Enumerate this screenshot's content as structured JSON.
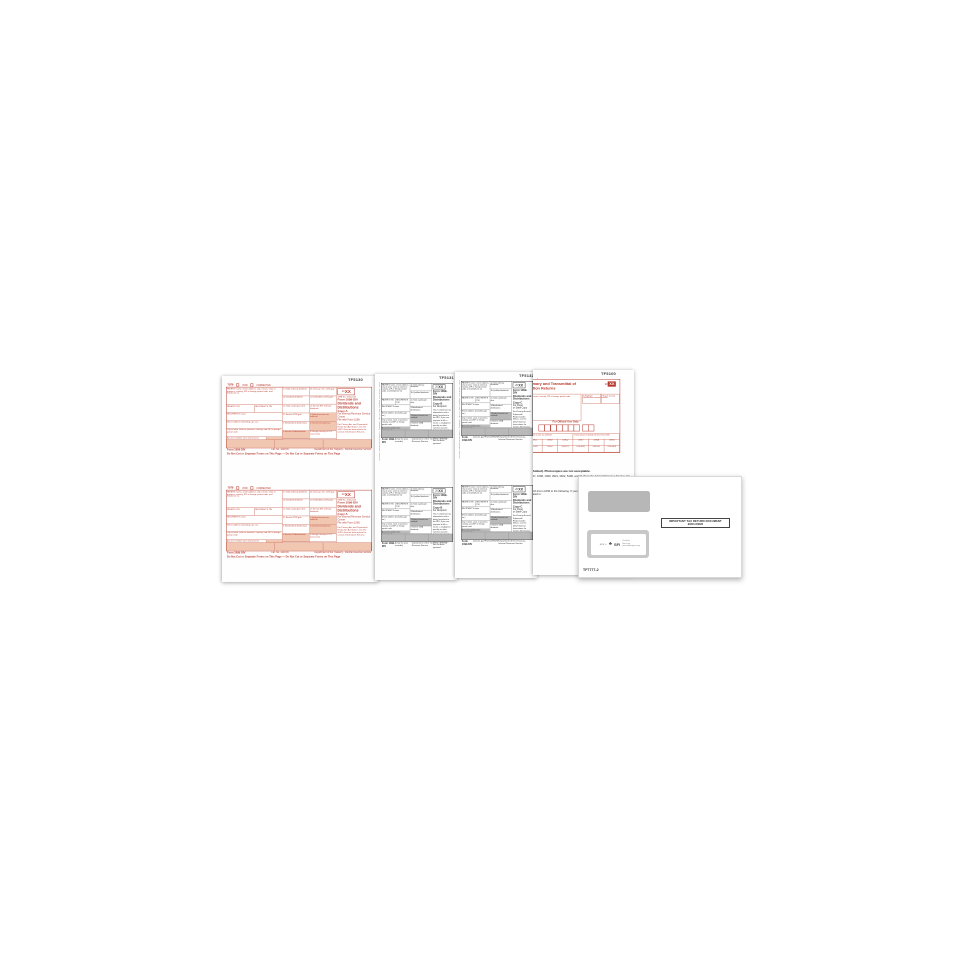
{
  "scene": {
    "description": "1099-DIV laser tax form set with double-window envelope on white background"
  },
  "sheet_codes": {
    "s1": "TF5130",
    "s2": "TF5131",
    "s3": "TF5132",
    "s4": "TF5100"
  },
  "edges": {
    "div_edge": "Form 1099-DIV   Department of the Treasury - Internal Revenue Service",
    "transmittal_edge": "Form 1096   Department of the Treasury Internal Revenue Service"
  },
  "form1099": {
    "corner": "7979",
    "void_label": "VOID",
    "corrected_label": "CORRECTED",
    "omb": "OMB No. 1545-0110",
    "year_prefix": "20",
    "year": "XX",
    "form_label": "Form 1099-DIV",
    "title": "Dividends and Distributions",
    "payer_label": "PAYER'S name, street address, city or town, state or province, country, ZIP or foreign postal code, and telephone no.",
    "payer_tin": "PAYER'S TIN",
    "recipient_tin": "RECIPIENT'S TIN",
    "recipient_name": "RECIPIENT'S name",
    "street": "Street address (including apt. no.)",
    "city": "City or town, state or province, country, and ZIP or foreign postal code",
    "account": "Account number (see instructions)",
    "boxes_a_col1": [
      "1a Total ordinary dividends",
      "1b Qualified dividends",
      "2a Total capital gain distr.",
      "2c Section 1202 gain",
      "3 Nondividend distributions",
      "5 Section 199A dividends",
      "7 Foreign tax paid"
    ],
    "boxes_a_col2": [
      "2b Unrecap. Sec. 1250 gain",
      "2d Collectibles (28%) gain",
      "2e Section 897 ordinary dividends",
      "4 Federal income tax withheld",
      "6 Investment expenses",
      "8 Foreign country or U.S. possession",
      "9 Cash liquidation distributions"
    ],
    "boxes_n": [
      "1a Total ordinary dividends",
      "1b Qualified dividends",
      "2a Total capital gain distr.",
      "3 Nondividend distributions",
      "4 Federal income tax withheld",
      "5 Section 199A dividends",
      "6 Investment expenses"
    ],
    "footer_form": "Form 1099-DIV",
    "footer_dept": "Department of the Treasury - Internal Revenue Service",
    "do_not_cut": "Do Not Cut or Separate Forms on This Page  —  Do Not Cut or Separate Forms on This Page",
    "copies": {
      "a": {
        "copy": "Copy A",
        "for_line": "For Internal Revenue Service Center",
        "note": "File with Form 1096.",
        "fine_print": "For Privacy Act and Paperwork Reduction Act Notice, see the 20XX General Instructions for Certain Information Returns.",
        "footer_mid": "Cat. No. 14415N"
      },
      "b": {
        "copy": "Copy B",
        "for_line": "For Recipient",
        "note": "(keep for your records)",
        "fine_print": "This is important tax information and is being furnished to the IRS. If you are required to file a return, a negligence penalty or other sanction may be imposed on you if this income is taxable and the IRS determines that it has not been reported.",
        "footer_mid": "(keep for your records)"
      },
      "c": {
        "copy": "Copy C",
        "for_line": "For Payer",
        "note": "or State Copy",
        "fine_print": "For Privacy Act and Paperwork Reduction Act Notice, see the 20XX General Instructions for Certain Information Returns.",
        "footer_mid": "www.irs.gov/Form1099DIV"
      }
    }
  },
  "form1096": {
    "form_label": "Form 1096",
    "dept": "Department of the Treasury Internal Revenue Service",
    "title_line1": "Annual Summary and Transmittal of",
    "title_line2": "U.S. Information Returns",
    "year_prefix": "20",
    "year": "XX",
    "filer_label": "FILER'S name, street address, city or town, state or province, country, ZIP or foreign postal code",
    "ein_label": "1 Employer identification number",
    "ssn_label": "2 Social security number",
    "official": "For Official Use Only",
    "mid_cells": [
      "3 Total number of forms",
      "4 Federal income tax withheld",
      "5 Total amount reported with this Form 1096"
    ],
    "grid_codes": [
      "W-2G",
      "1097-BTC",
      "1098",
      "1098-C",
      "1098-E",
      "1098-Q",
      "1098-T",
      "1099-A",
      "1099-B",
      "1099-C",
      "1099-DIV",
      "1099-G",
      "1099-INT",
      "1099-K",
      "1099-LTC",
      "1099-MISC",
      "1099-OID",
      "1099-PATR"
    ],
    "instr_bold": "Send the forms in a flat mailing (not folded). Photocopies are not acceptable.",
    "instr_para": "Use Form 1096 to transmit paper Forms 1097, 1098, 1099, 3921, 3922, 5498, and W-2G to the Internal Revenue Service. Do not use this form to transmit electronically.",
    "where_heading": "Where To File",
    "where_para": "Send all information returns filed on paper with Form 1096 to the following. If your principal business, office or agency, or legal residence in the case of an individual, is located in:",
    "where_address": "Internal Revenue Service Center"
  },
  "envelope": {
    "notice": "IMPORTANT TAX RETURN DOCUMENT ENCLOSED",
    "recycle_label": "env +",
    "sfi_label": "SFI",
    "sfi_caption": "Certified Sourcing www.sfiprogram.org",
    "code": "TF7777-2"
  }
}
